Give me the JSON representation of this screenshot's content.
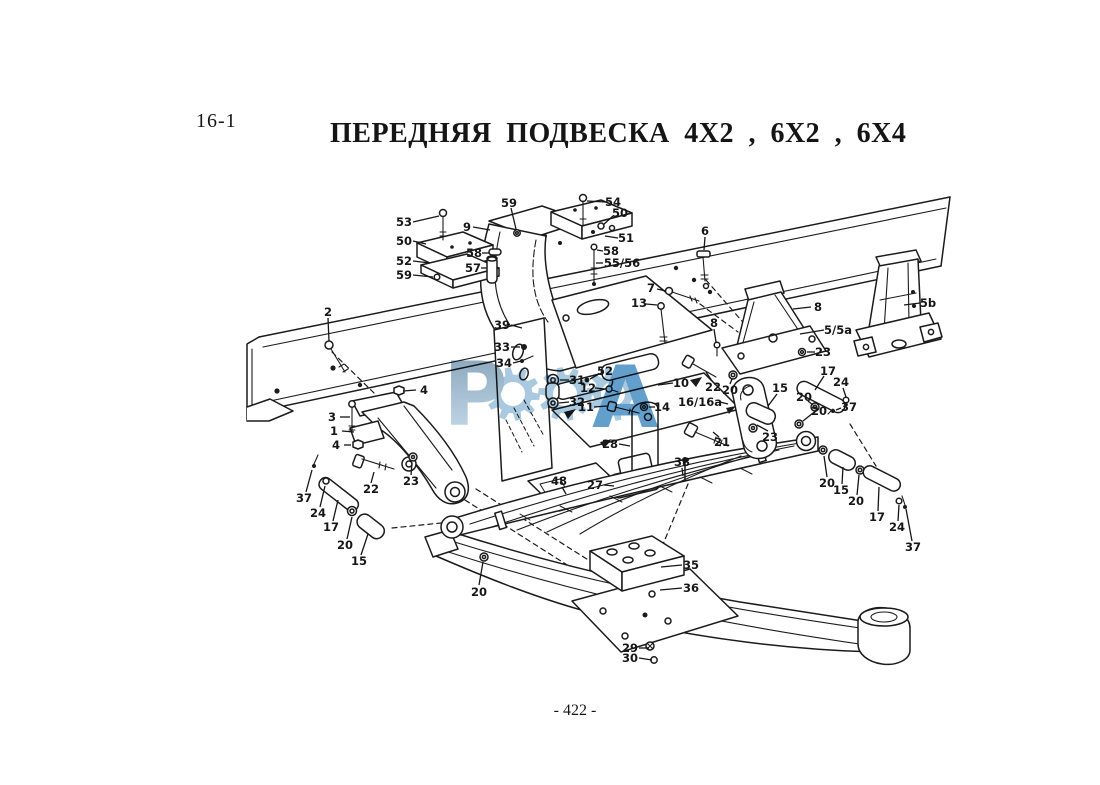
{
  "page": {
    "section": "16-1",
    "title": "ПЕРЕДНЯЯ ПОДВЕСКА 4X2 , 6X2 , 6X4",
    "page_number": "- 422 -"
  },
  "watermark": {
    "text": "РОССА",
    "letter_first": "Р",
    "letter_last": "А",
    "gear_color": "#9cc2dc",
    "dark_color": "#4c92c6",
    "grad_top": "#7292ac",
    "grad_bottom": "#c3dcec"
  },
  "diagram": {
    "label_font_size": 11.5,
    "labels": [
      {
        "t": "53",
        "x": 404,
        "y": 222,
        "l": [
          413,
          222,
          439,
          216
        ]
      },
      {
        "t": "50",
        "x": 404,
        "y": 241,
        "l": [
          413,
          241,
          426,
          244
        ]
      },
      {
        "t": "52",
        "x": 404,
        "y": 261,
        "l": [
          413,
          261,
          430,
          263
        ]
      },
      {
        "t": "59",
        "x": 404,
        "y": 275,
        "l": [
          413,
          275,
          433,
          277
        ]
      },
      {
        "t": "9",
        "x": 467,
        "y": 227,
        "l": [
          473,
          227,
          490,
          230
        ]
      },
      {
        "t": "59",
        "x": 509,
        "y": 203,
        "l": [
          511,
          208,
          516,
          229
        ]
      },
      {
        "t": "58",
        "x": 474,
        "y": 253,
        "l": [
          482,
          253,
          489,
          253
        ]
      },
      {
        "t": "57",
        "x": 473,
        "y": 268,
        "l": [
          481,
          268,
          487,
          268
        ]
      },
      {
        "t": "54",
        "x": 613,
        "y": 202,
        "l": [
          605,
          202,
          587,
          201
        ]
      },
      {
        "t": "50",
        "x": 620,
        "y": 213,
        "l": [
          613,
          216,
          603,
          225
        ]
      },
      {
        "t": "51",
        "x": 626,
        "y": 238,
        "l": [
          618,
          238,
          605,
          236
        ]
      },
      {
        "t": "58",
        "x": 611,
        "y": 251,
        "l": [
          603,
          251,
          597,
          250
        ]
      },
      {
        "t": "55/56",
        "x": 622,
        "y": 263,
        "l": [
          603,
          263,
          596,
          263
        ]
      },
      {
        "t": "6",
        "x": 705,
        "y": 231,
        "l": [
          705,
          237,
          704,
          250
        ]
      },
      {
        "t": "7",
        "x": 651,
        "y": 288,
        "l": [
          657,
          289,
          666,
          291
        ]
      },
      {
        "t": "13",
        "x": 639,
        "y": 303,
        "l": [
          646,
          304,
          657,
          305
        ]
      },
      {
        "t": "8",
        "x": 714,
        "y": 323,
        "l": [
          714,
          329,
          716,
          342
        ]
      },
      {
        "t": "8",
        "x": 818,
        "y": 307,
        "l": [
          811,
          307,
          793,
          309
        ]
      },
      {
        "t": "5/5a",
        "x": 838,
        "y": 330,
        "l": [
          824,
          330,
          800,
          334
        ]
      },
      {
        "t": "5b",
        "x": 928,
        "y": 303,
        "l": [
          920,
          303,
          904,
          305
        ]
      },
      {
        "t": "23",
        "x": 823,
        "y": 352,
        "l": [
          815,
          352,
          807,
          352
        ]
      },
      {
        "t": "2",
        "x": 328,
        "y": 312,
        "l": [
          328,
          318,
          329,
          341
        ]
      },
      {
        "t": "39",
        "x": 502,
        "y": 325,
        "l": [
          511,
          325,
          522,
          328
        ]
      },
      {
        "t": "33",
        "x": 502,
        "y": 347,
        "l": [
          511,
          347,
          520,
          347
        ]
      },
      {
        "t": "34",
        "x": 504,
        "y": 363,
        "l": [
          513,
          363,
          521,
          361
        ]
      },
      {
        "t": "31",
        "x": 577,
        "y": 380,
        "l": [
          569,
          380,
          560,
          380
        ]
      },
      {
        "t": "32",
        "x": 577,
        "y": 402,
        "l": [
          569,
          402,
          559,
          403
        ]
      },
      {
        "t": "52",
        "x": 605,
        "y": 371,
        "l": [
          599,
          374,
          590,
          379
        ]
      },
      {
        "t": "12",
        "x": 588,
        "y": 388,
        "l": [
          595,
          388,
          605,
          389
        ]
      },
      {
        "t": "11",
        "x": 586,
        "y": 407,
        "l": [
          594,
          407,
          607,
          406
        ]
      },
      {
        "t": "10",
        "x": 681,
        "y": 383,
        "l": [
          673,
          383,
          658,
          385
        ]
      },
      {
        "t": "14",
        "x": 662,
        "y": 407,
        "l": [
          655,
          407,
          649,
          407
        ]
      },
      {
        "t": "16/16a",
        "x": 700,
        "y": 402,
        "l": [
          720,
          402,
          728,
          404
        ]
      },
      {
        "t": "22",
        "x": 713,
        "y": 387,
        "l": [
          712,
          381,
          706,
          372
        ]
      },
      {
        "t": "20",
        "x": 730,
        "y": 390,
        "l": [
          730,
          384,
          732,
          379
        ]
      },
      {
        "t": "15",
        "x": 780,
        "y": 388,
        "l": [
          777,
          394,
          768,
          406
        ]
      },
      {
        "t": "17",
        "x": 828,
        "y": 371,
        "l": [
          824,
          376,
          815,
          390
        ]
      },
      {
        "t": "24",
        "x": 841,
        "y": 382,
        "l": [
          843,
          388,
          846,
          397
        ]
      },
      {
        "t": "37",
        "x": 849,
        "y": 407,
        "l": [
          841,
          408,
          836,
          410
        ]
      },
      {
        "t": "20",
        "x": 804,
        "y": 397,
        "l": [
          808,
          401,
          813,
          405
        ]
      },
      {
        "t": "20",
        "x": 819,
        "y": 411,
        "l": [
          813,
          413,
          803,
          421
        ]
      },
      {
        "t": "23",
        "x": 770,
        "y": 437,
        "l": [
          768,
          431,
          757,
          425
        ]
      },
      {
        "t": "21",
        "x": 722,
        "y": 442,
        "l": [
          719,
          437,
          713,
          432
        ]
      },
      {
        "t": "3",
        "x": 332,
        "y": 417,
        "l": [
          340,
          417,
          350,
          417
        ]
      },
      {
        "t": "1",
        "x": 334,
        "y": 431,
        "l": [
          342,
          431,
          354,
          432
        ]
      },
      {
        "t": "4",
        "x": 424,
        "y": 390,
        "l": [
          416,
          390,
          403,
          391
        ]
      },
      {
        "t": "4",
        "x": 336,
        "y": 445,
        "l": [
          344,
          445,
          351,
          445
        ]
      },
      {
        "t": "22",
        "x": 371,
        "y": 489,
        "l": [
          371,
          483,
          374,
          472
        ]
      },
      {
        "t": "23",
        "x": 411,
        "y": 481,
        "l": [
          411,
          475,
          412,
          463
        ]
      },
      {
        "t": "37",
        "x": 304,
        "y": 498,
        "l": [
          306,
          492,
          312,
          470
        ]
      },
      {
        "t": "24",
        "x": 318,
        "y": 513,
        "l": [
          320,
          507,
          325,
          486
        ]
      },
      {
        "t": "17",
        "x": 331,
        "y": 527,
        "l": [
          333,
          521,
          338,
          500
        ]
      },
      {
        "t": "20",
        "x": 345,
        "y": 545,
        "l": [
          347,
          539,
          352,
          517
        ]
      },
      {
        "t": "15",
        "x": 359,
        "y": 561,
        "l": [
          361,
          555,
          368,
          534
        ]
      },
      {
        "t": "20",
        "x": 479,
        "y": 592,
        "l": [
          479,
          585,
          483,
          562
        ]
      },
      {
        "t": "28",
        "x": 610,
        "y": 444,
        "l": [
          619,
          444,
          630,
          446
        ]
      },
      {
        "t": "48",
        "x": 559,
        "y": 481,
        "l": [
          562,
          487,
          566,
          494
        ]
      },
      {
        "t": "27",
        "x": 595,
        "y": 485,
        "l": [
          604,
          485,
          614,
          486
        ]
      },
      {
        "t": "38",
        "x": 682,
        "y": 462,
        "l": [
          682,
          468,
          683,
          476
        ]
      },
      {
        "t": "35",
        "x": 691,
        "y": 565,
        "l": [
          682,
          565,
          661,
          567
        ]
      },
      {
        "t": "36",
        "x": 691,
        "y": 588,
        "l": [
          682,
          588,
          660,
          590
        ]
      },
      {
        "t": "29",
        "x": 630,
        "y": 648,
        "l": [
          639,
          648,
          649,
          648
        ]
      },
      {
        "t": "30",
        "x": 630,
        "y": 658,
        "l": [
          639,
          658,
          652,
          660
        ]
      },
      {
        "t": "20",
        "x": 827,
        "y": 483,
        "l": [
          827,
          477,
          824,
          456
        ]
      },
      {
        "t": "15",
        "x": 841,
        "y": 490,
        "l": [
          842,
          484,
          843,
          467
        ]
      },
      {
        "t": "20",
        "x": 856,
        "y": 501,
        "l": [
          857,
          495,
          859,
          475
        ]
      },
      {
        "t": "17",
        "x": 877,
        "y": 517,
        "l": [
          878,
          511,
          879,
          487
        ]
      },
      {
        "t": "24",
        "x": 897,
        "y": 527,
        "l": [
          898,
          521,
          899,
          505
        ]
      },
      {
        "t": "37",
        "x": 913,
        "y": 547,
        "l": [
          912,
          541,
          906,
          509
        ]
      }
    ]
  }
}
